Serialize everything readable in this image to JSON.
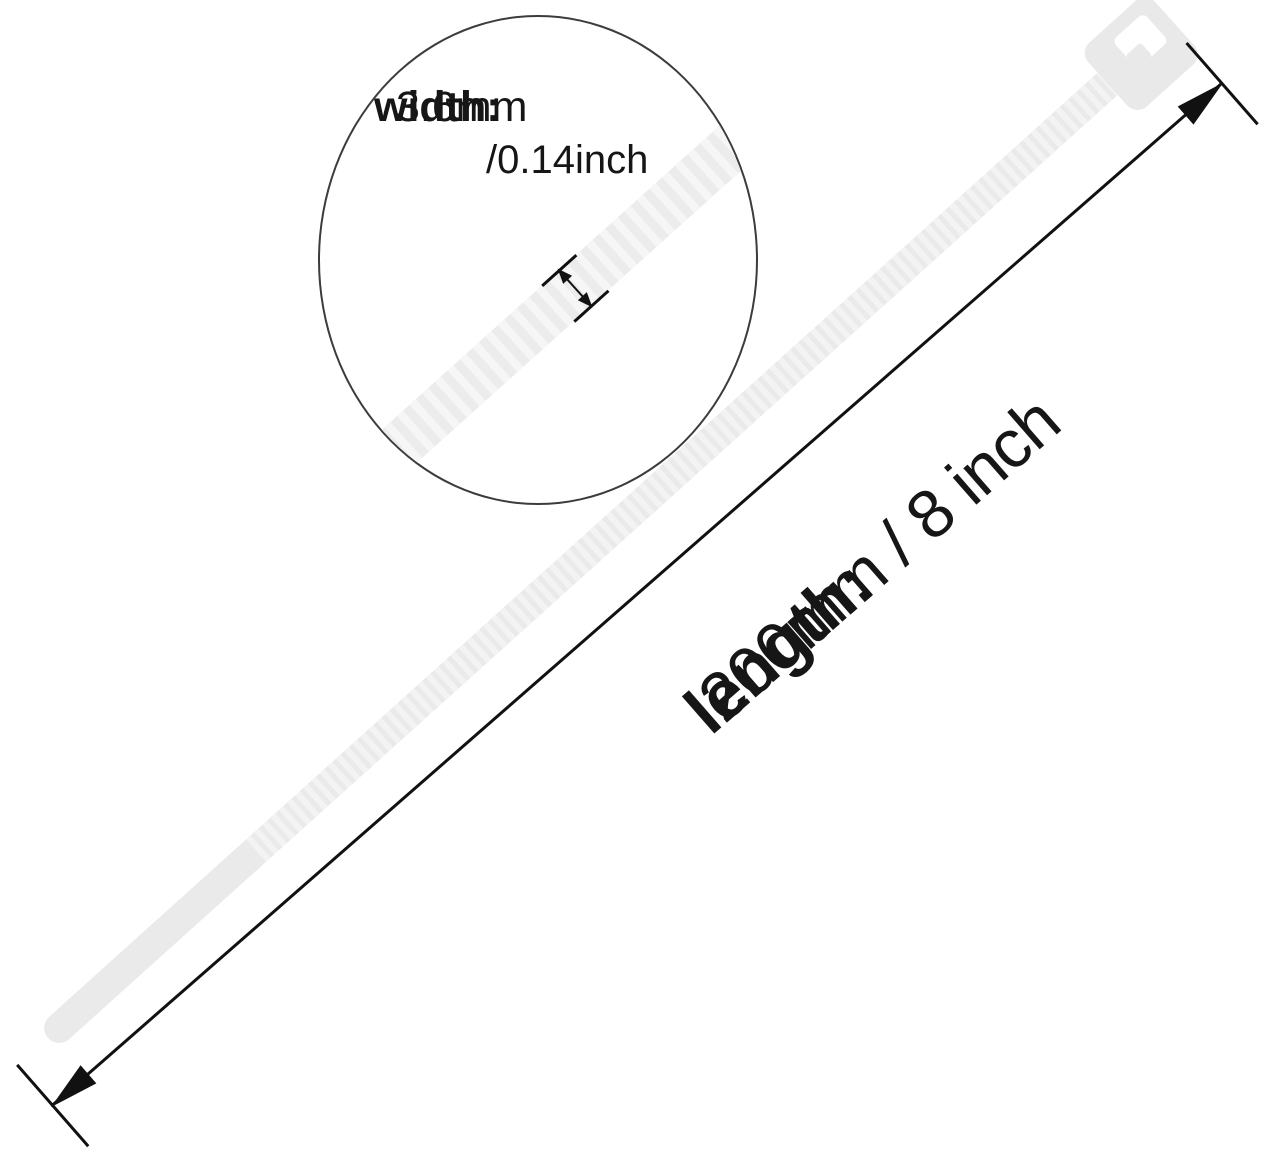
{
  "inset": {
    "width_label": "width:",
    "width_mm": "3.6mm",
    "width_inch": "/0.14inch"
  },
  "length_annotation": {
    "label": "length:",
    "value": "200mm / 8 inch"
  },
  "icons": {
    "product": "cable-tie",
    "magnifier": "magnifier-circle",
    "width_arrow": "double-headed-arrow",
    "length_arrow": "double-headed-dimension-arrow"
  },
  "colors": {
    "background": "#ffffff",
    "tie_fill": "#eaeaea",
    "tie_rib": "#f3f3f3",
    "inset_band_fill": "#ececec",
    "inset_band_rib": "#f6f6f6",
    "annotation_line": "#111111",
    "circle_stroke": "#3c3c3c",
    "text": "#161616"
  }
}
